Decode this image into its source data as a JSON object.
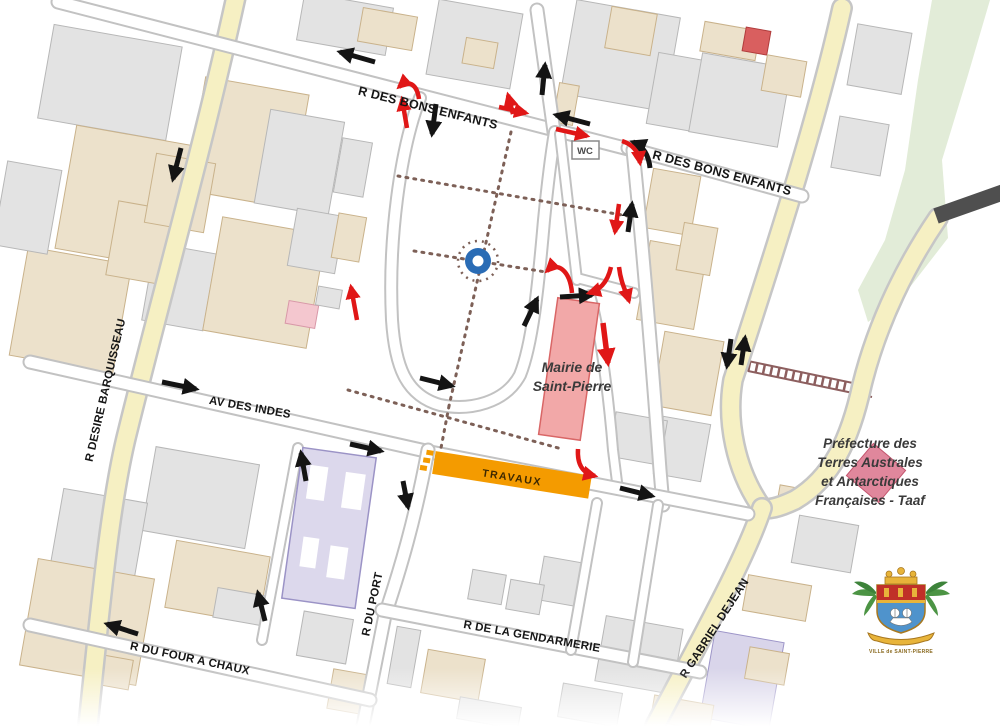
{
  "map": {
    "streets": {
      "bons_enfants_1": "R DES BONS ENFANTS",
      "bons_enfants_2": "R DES BONS ENFANTS",
      "desire_barquisseau": "R DESIRE BARQUISSEAU",
      "av_des_indes": "AV DES INDES",
      "r_du_port": "R DU PORT",
      "de_la_gendarmerie": "R DE LA GENDARMERIE",
      "du_four_a_chaux": "R DU FOUR A CHAUX",
      "gabriel_dejean": "R GABRIEL DEJEAN"
    },
    "labels": {
      "mairie_line1": "Mairie de",
      "mairie_line2": "Saint-Pierre",
      "prefecture_line1": "Préfecture des",
      "prefecture_line2": "Terres Australes",
      "prefecture_line3": "et Antarctiques",
      "prefecture_line4": "Françaises - Taaf",
      "wc": "WC",
      "travaux": "TRAVAUX",
      "crest_caption": "VILLE de SAINT-PIERRE"
    },
    "colors": {
      "road_main_yellow": "#f6f0c3",
      "travaux_orange": "#f49b00",
      "arrow_existing_black": "#141414",
      "arrow_modified_red": "#e01717",
      "mairie_pink": "#f2a8a8",
      "prefecture_pink": "#e0879c",
      "fountain_blue": "#2a6cb5",
      "building_grey": "#e3e3e3",
      "building_beige": "#ece1cb",
      "building_purple": "#dcd8ec",
      "park_path_brown": "#7d6057"
    }
  }
}
